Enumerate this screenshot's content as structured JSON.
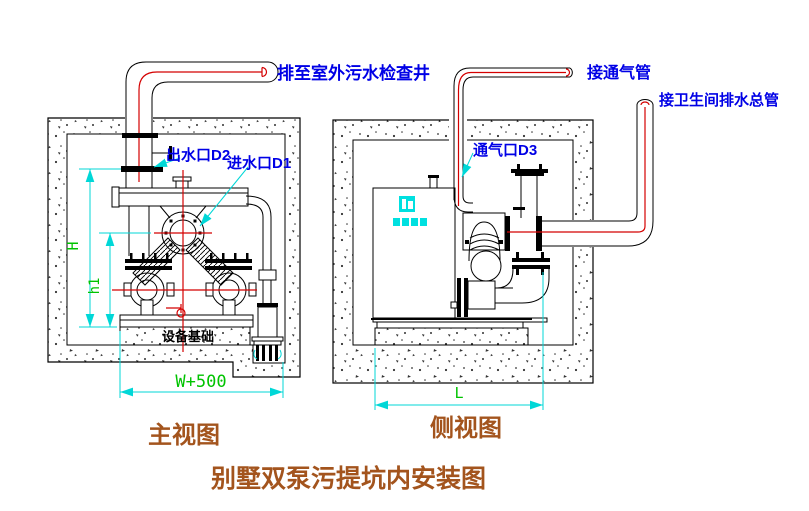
{
  "title": {
    "text": "别墅双泵污提坑内安装图"
  },
  "front_view": {
    "caption": "主视图",
    "pipe_note": "排至室外污水检查井",
    "outlet_label": "出水口D2",
    "inlet_label": "进水口D1",
    "foundation_label": "设备基础",
    "dim_height": "H",
    "dim_inlet_height": "h1",
    "dim_width": "W+500"
  },
  "side_view": {
    "caption": "侧视图",
    "vent_note": "接通气管",
    "drain_note": "接卫生间排水总管",
    "vent_label": "通气口D3",
    "dim_length": "L"
  },
  "colors": {
    "annotation_blue": "#0000E6",
    "dimension_cyan": "#00D7D7",
    "dimension_green": "#00C300",
    "pipe_red": "#D40000",
    "caption_brown": "#A3541D",
    "line_black": "#000000"
  }
}
